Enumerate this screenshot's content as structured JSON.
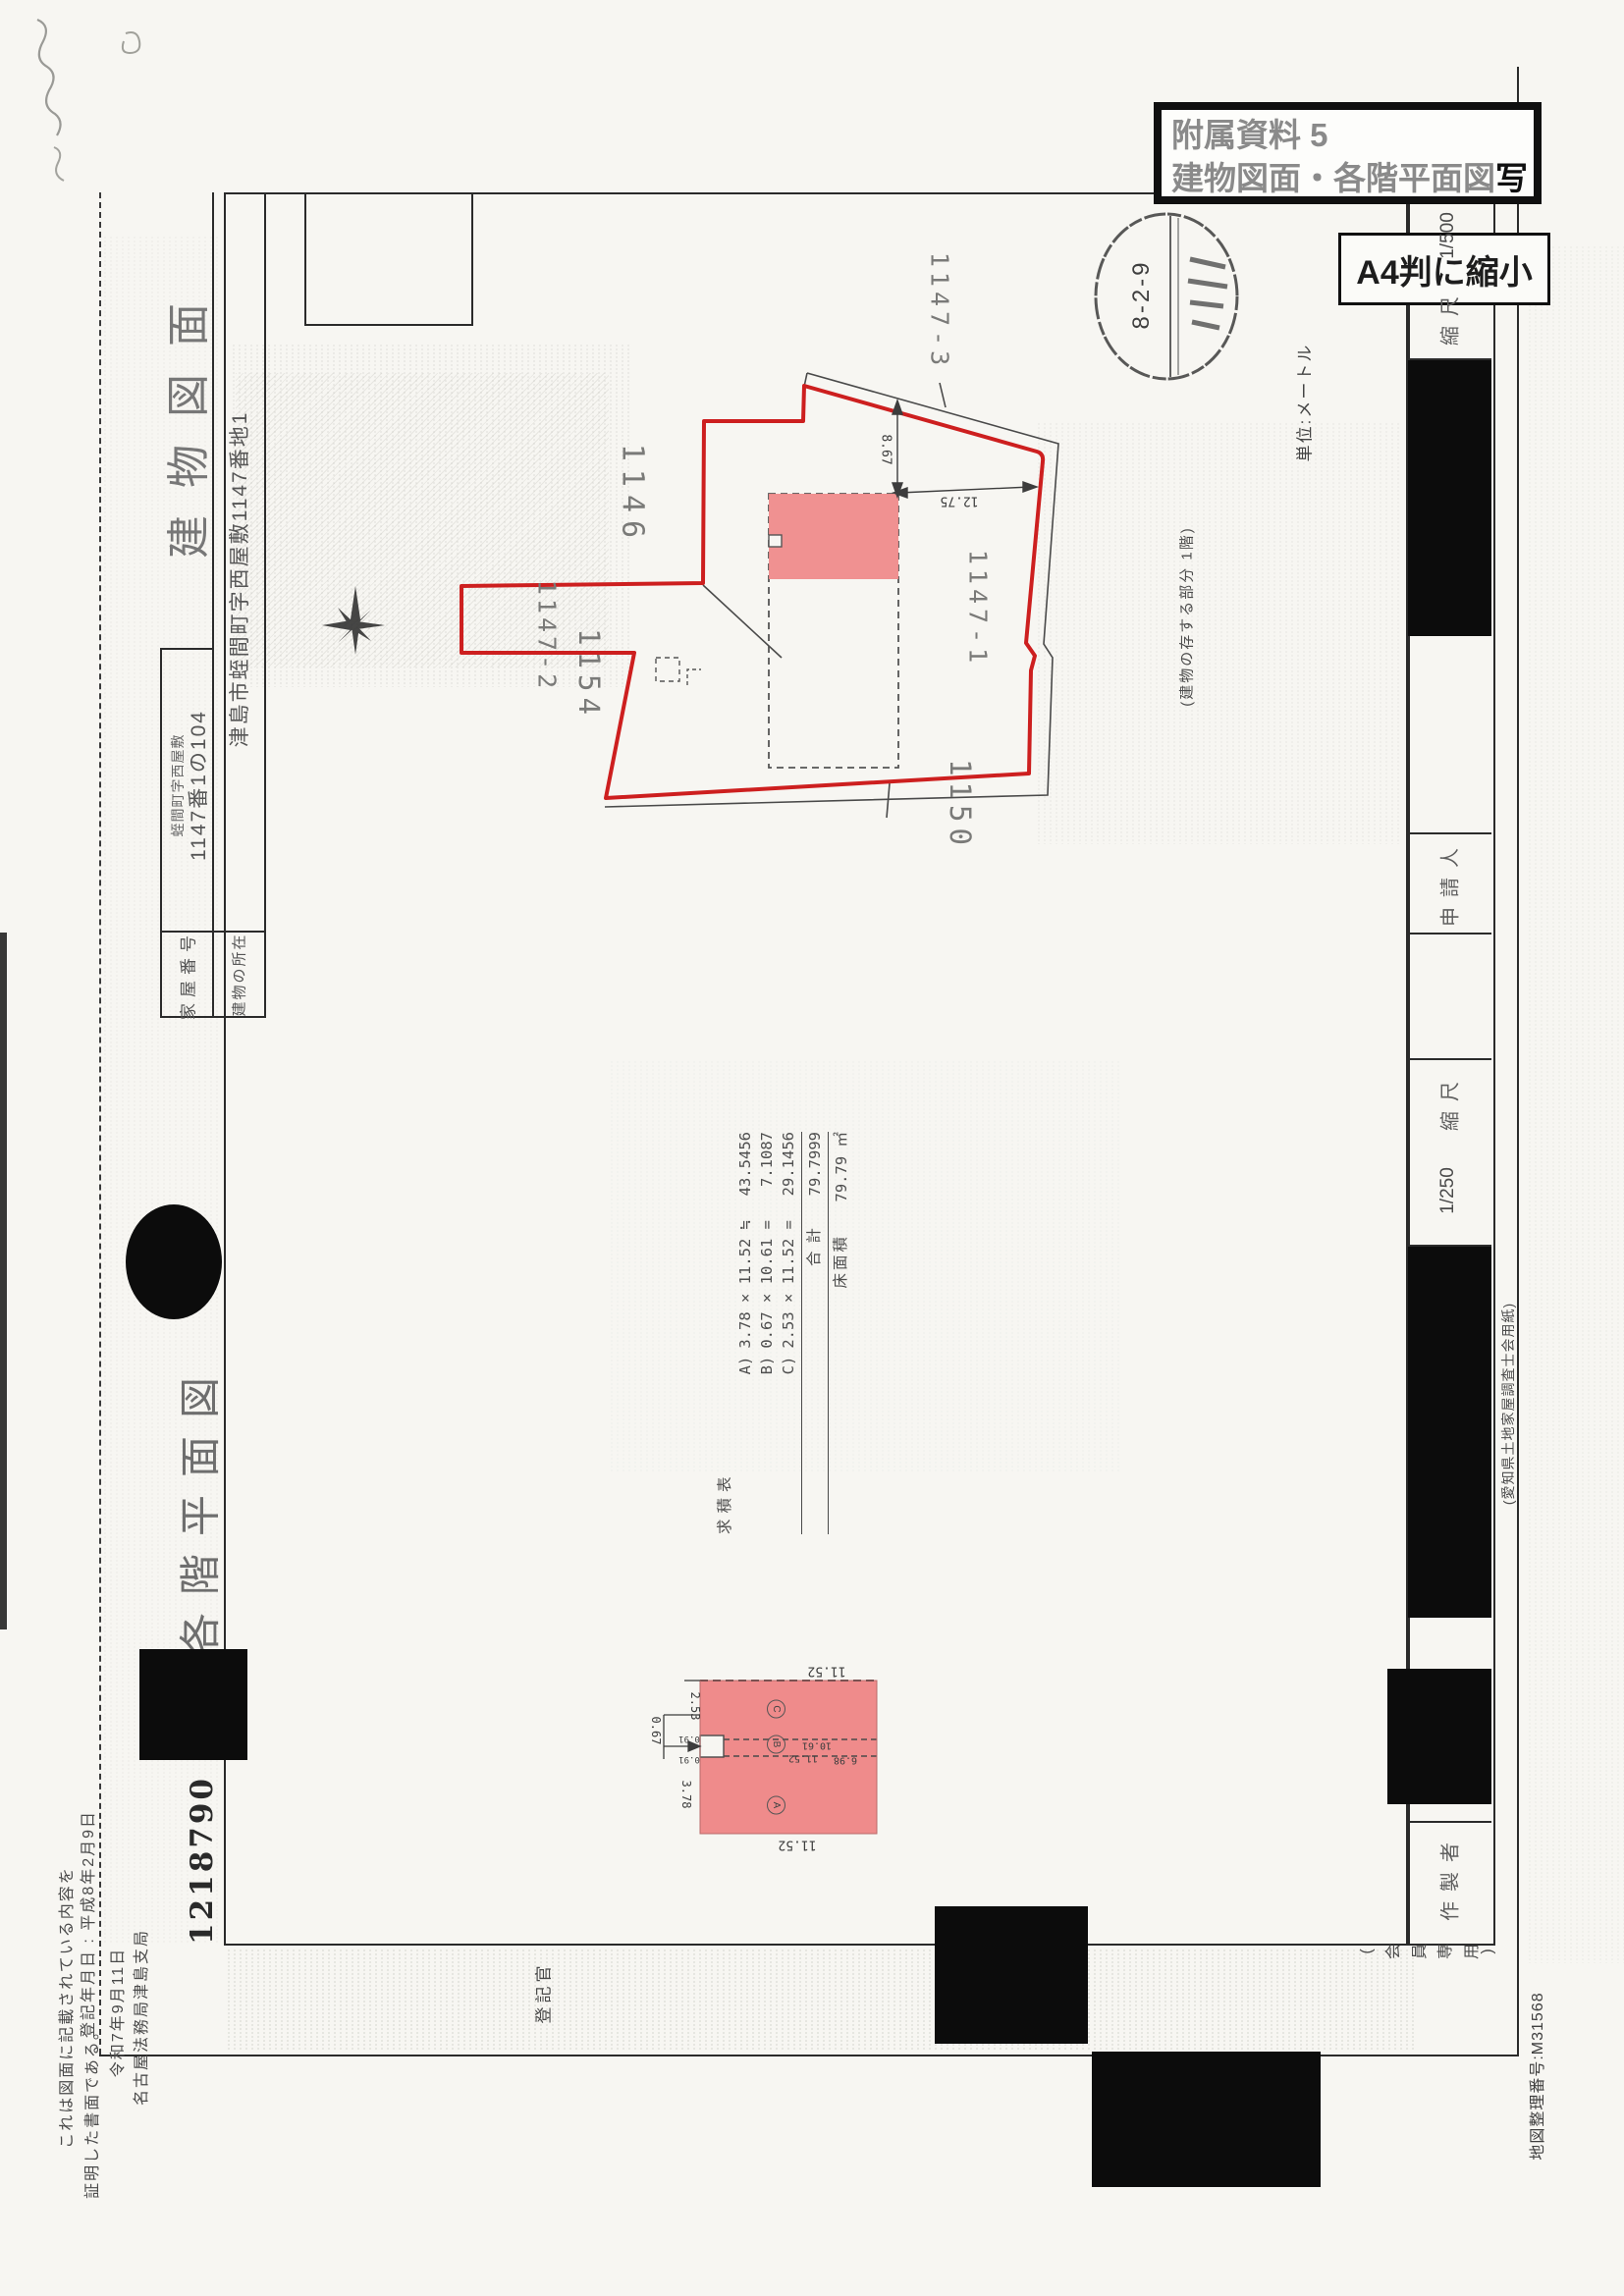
{
  "stamps": {
    "attachment_line1": "附属資料 5",
    "attachment_line2_main": "建物図面・各階平面図",
    "attachment_line2_suffix": "写",
    "reduced_label": "A4判に縮小",
    "receipt_date": "8-2-9",
    "filing_number": "1218790"
  },
  "titles": {
    "building_drawing": "建物図面",
    "floor_plan": "各階平面図"
  },
  "info_table": {
    "house_number_label": "家屋番号",
    "house_number_value_small": "蛭間町字西屋敷",
    "house_number_value": "1147番1の104",
    "location_label": "建物の所在",
    "location_value": "津島市蛭間町字西屋敷1147番地1"
  },
  "map": {
    "parcel_1146": "1146",
    "parcel_1147_2": "1147-2",
    "parcel_1154": "1154",
    "parcel_1147_3": "1147-3",
    "parcel_1147_1": "1147-1",
    "parcel_1150": "1150",
    "dim_vertical": "8.67",
    "dim_horizontal": "12.75",
    "unit_note": "単位:メートル",
    "building_part_note": "(建物の存する部分 1階)"
  },
  "area_table": {
    "title": "求積表",
    "row_a_label": "A)",
    "row_a_expr": "3.78 × 11.52 ≒",
    "row_a_value": "43.5456",
    "row_b_label": "B)",
    "row_b_expr": "0.67 × 10.61 =",
    "row_b_value": "7.1087",
    "row_c_label": "C)",
    "row_c_expr": "2.53 × 11.52 =",
    "row_c_value": "29.1456",
    "total_label": "合計",
    "total_value": "79.7999",
    "floor_area_label": "床面積",
    "floor_area_value": "79.79 ㎡"
  },
  "floor_plan": {
    "dim_top": "11.52",
    "dim_c_height": "2.53",
    "dim_b_height": "0.67",
    "dim_notch_upper": "0.91",
    "dim_notch_lower": "0.91",
    "dim_a_height": "3.78",
    "dim_b_length": "10.61",
    "dim_mid_length": "11.52",
    "dim_right": "6.98",
    "dim_bottom": "11.52",
    "section_a": "A",
    "section_b": "B",
    "section_c": "C"
  },
  "side_strip": {
    "scale_top_label": "縮尺",
    "scale_top_value": "1/500",
    "applicant_label": "申請人",
    "scale_bottom_label": "縮尺",
    "scale_bottom_value": "1/250",
    "preparer_label": "作製者",
    "paper_note": "(愛知県土地家屋調査士会用紙)",
    "member_note": "(会員専用)",
    "map_number": "地図整理番号:M31568"
  },
  "footer": {
    "registration_date": "登記年月日 : 平成8年2月9日",
    "cert_line1": "これは図面に記載されている内容を",
    "cert_line2": "証明した書面である。",
    "cert_date": "令和7年9月11日",
    "cert_office": "名古屋法務局津島支局",
    "registrar": "登記官"
  }
}
